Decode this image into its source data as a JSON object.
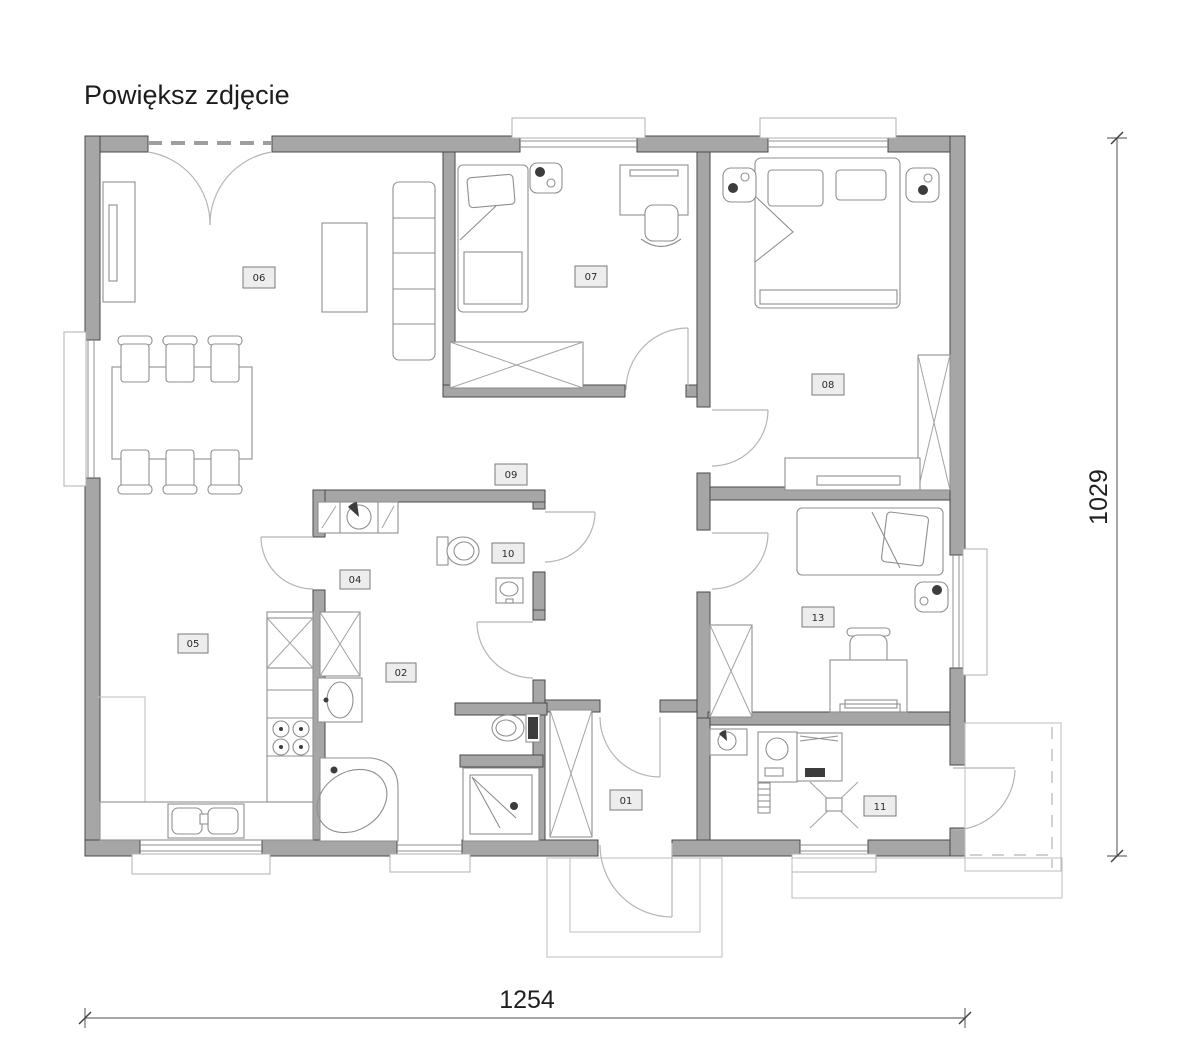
{
  "page": {
    "enlarge_link": "Powiększ zdjęcie"
  },
  "dimensions": {
    "width_label": "1254",
    "height_label": "1029"
  },
  "rooms": {
    "hall": {
      "number": "01"
    },
    "bathroom": {
      "number": "02"
    },
    "utility": {
      "number": "04"
    },
    "kitchen": {
      "number": "05"
    },
    "living": {
      "number": "06"
    },
    "bedroom1": {
      "number": "07"
    },
    "bedroom2": {
      "number": "08"
    },
    "corridor": {
      "number": "09"
    },
    "wc": {
      "number": "10"
    },
    "boiler": {
      "number": "11"
    },
    "bedroom3": {
      "number": "13"
    }
  },
  "colors": {
    "wall": "#a6a6a6",
    "furniture_line": "#8f8f8f",
    "dimension_line": "#6f6f6f",
    "text": "#1f1f1f"
  }
}
